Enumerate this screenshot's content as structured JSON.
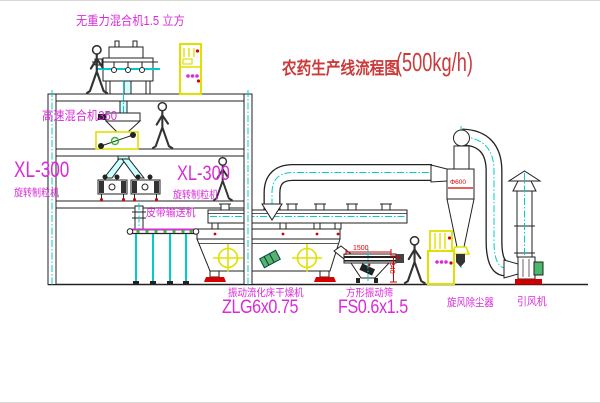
{
  "title": {
    "text": "农药生产线流程图",
    "capacity": "(500kg/h)",
    "color": "#cc3a3a"
  },
  "labels": {
    "gravity_mixer": "无重力混合机1.5 立方",
    "high_speed_mixer": "高速混合机350",
    "granulator_left_model": "XL-300",
    "granulator_left_name": "旋转制粒机",
    "granulator_right_model": "XL-300",
    "granulator_right_name": "旋转制粒机",
    "belt_conveyor": "皮带输送机",
    "dryer_name": "振动流化床干燥机",
    "dryer_model": "ZLG6x0.75",
    "sieve_name": "方形振动筛",
    "sieve_model": "FS0.6x1.5",
    "cyclone": "旋风除尘器",
    "fan": "引风机"
  },
  "dimensions": {
    "sieve_length": "1500",
    "sieve_height": "340",
    "cyclone_diameter": "Φ600"
  },
  "colors": {
    "label": "#d92bd9",
    "dimension": "#dd0000",
    "centerline": "#00cccc",
    "cabinet_yellow": "#e0e000",
    "accent_red": "#d60000",
    "machine_green": "#2eb82e",
    "line": "#222222"
  }
}
